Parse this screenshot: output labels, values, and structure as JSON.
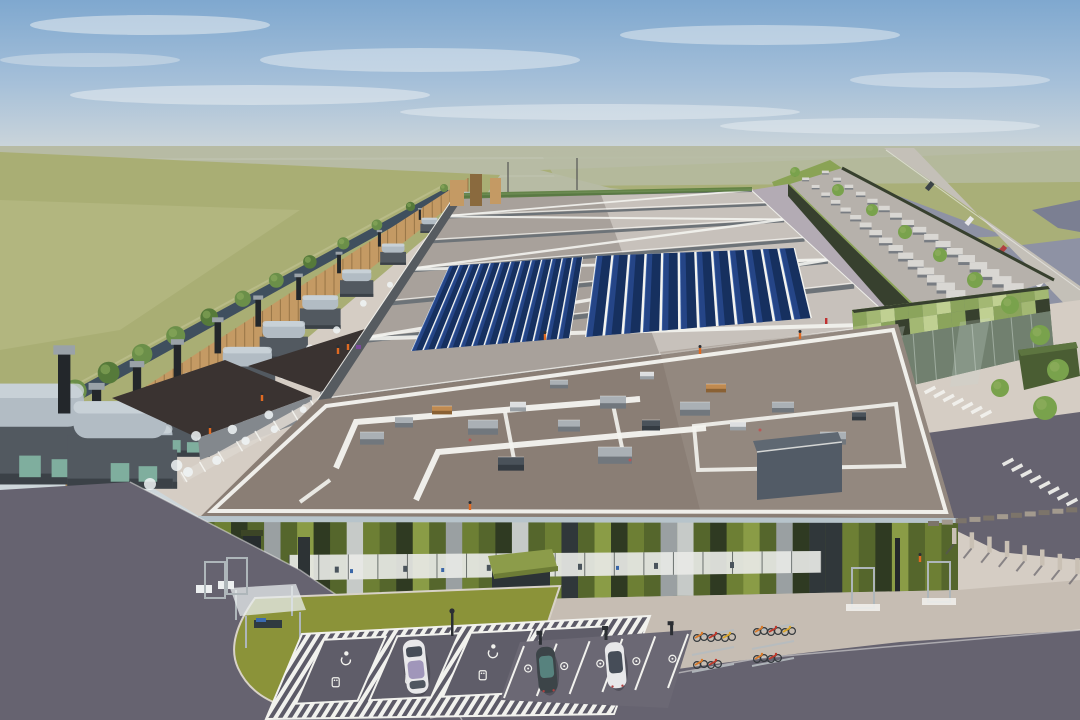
{
  "meta": {
    "title": "Aerial architectural rendering of a large data-center campus with solar roof, generator yard, green-panel office facade, EV parking and bike racks"
  },
  "palette": {
    "sky_top": "#7fa8cf",
    "sky_mid": "#a6c0d9",
    "sky_horizon": "#cdd6da",
    "cloud": "#e8edf1",
    "far_field": "#b7bba4",
    "field_left": "#a9ae74",
    "field_left_light": "#c2c595",
    "field_right": "#a9af78",
    "pond": "#8e92a4",
    "pond_dark": "#7b7f92",
    "canal": "#3f4f5e",
    "bush": "#6b8f49",
    "bush_dark": "#567a3a",
    "tree": "#79a24c",
    "tree_light": "#8fae5e",
    "berm": "#8aa355",
    "road_on_berm": "#c4c0b8",
    "timber": "#c49a64",
    "timber_dark": "#8a6a3e",
    "gen_body": "#525960",
    "gen_top": "#b2bcc4",
    "gen_top_light": "#cdd6dc",
    "gen_base": "#3b4147",
    "gen_teal": "#7fae9e",
    "stack": "#23272b",
    "stack_cap": "#9aa2a8",
    "steam": "#f0f4f6",
    "dark_roof": "#3a3331",
    "dark_roof2": "#46403d",
    "dark_wall": "#83888d",
    "main_roof_left": "#a8a19b",
    "main_roof_right": "#c7c1bb",
    "beam": "#6d7378",
    "roof_white": "#f4f4f0",
    "solar_dark": "#16305f",
    "solar_mid": "#27488c",
    "solar_light": "#3f68b0",
    "front_roof": "#8a7e75",
    "front_roof_light": "#9b9087",
    "equip_top": "#aab0b5",
    "equip_side": "#71777d",
    "white_top": "#dcdee0",
    "white_side": "#9aa0a5",
    "charcoal_top": "#4a525a",
    "charcoal_side": "#343b42",
    "tan_top": "#c08a50",
    "tan_side": "#8a6134",
    "screen_box": "#525b66",
    "screen_top": "#5f6872",
    "green_wall_dark": "#37402e",
    "right_roof": "#b6b1ab",
    "unit_white": "#d9d7d3",
    "court": "#b3abb4",
    "pavilion_green1": "#a3b873",
    "pavilion_green2": "#8ba45c",
    "pavilion_green3": "#c0d092",
    "glass": "#71806f",
    "glass_light": "#c3cfc6",
    "hedge_box": "#4a5d33",
    "hedge_box_top": "#5d7540",
    "f_dark": "#2f3a22",
    "f_olive": "#55662c",
    "f_mid": "#6d7f34",
    "f_bright": "#8a9c46",
    "f_gray": "#9aa0a2",
    "f_light": "#c6cac8",
    "f_charcoal": "#30373a",
    "parapet": "#b7c4cb",
    "window": "#e8e9e6",
    "window_frame": "#3a4140",
    "canopy": "#8c9c4a",
    "canopy_dark": "#6d7c36",
    "apron": "#c6bdb3",
    "apron_light": "#d5cdc4",
    "asphalt": "#666370",
    "asphalt2": "#6b6874",
    "lawn": "#8b9339",
    "hatch_dark": "#5c5a67",
    "stall": "#5f5d69",
    "line_white": "#f2f2ee",
    "car_white": "#e8e8ea",
    "car_dark": "#3c4448",
    "car_glass": "#343c48",
    "car_teal": "#5a8a84",
    "car_red": "#b04040",
    "car_roof_purple": "#7a6aa0",
    "post_dark": "#2b2e33",
    "rack_metal": "#aeb6ba",
    "fence_post": "#c9c0b4",
    "fence_shadow": "#55525c",
    "person": "#e06a22",
    "person_red": "#c03030",
    "person_purple": "#7a4a9a",
    "head": "#2c2f33"
  },
  "scene": {
    "roof": {
      "bay_fractions": [
        0,
        0.1,
        0.22,
        0.36,
        0.52,
        0.7,
        1
      ]
    },
    "solar": {
      "rows_a": 13,
      "rows_b": 12
    },
    "generators": {
      "count": 10
    },
    "fence": {
      "plank_count": 46
    },
    "canal_bushes": 14,
    "right_hall": {
      "units_per_row": 17,
      "rows": [
        0.3,
        0.68
      ]
    },
    "pavilion": {
      "checker_columns": 14,
      "checker_rows": 2
    },
    "facade": {
      "panel_pattern": [
        "o",
        "m",
        "d",
        "o",
        "g",
        "o",
        "b",
        "d",
        "o",
        "w",
        "m",
        "o",
        "d",
        "b",
        "o",
        "g",
        "m",
        "o",
        "d",
        "w",
        "o",
        "m",
        "c",
        "o",
        "b",
        "d",
        "m",
        "o",
        "g",
        "w",
        "o",
        "d",
        "m",
        "b",
        "o",
        "g",
        "d",
        "c",
        "c",
        "m",
        "o",
        "d",
        "b",
        "o",
        "m",
        "o"
      ],
      "panel_color_map": {
        "d": "f_dark",
        "o": "f_olive",
        "m": "f_mid",
        "b": "f_bright",
        "g": "f_gray",
        "w": "f_light",
        "c": "f_charcoal"
      },
      "window_mullions": 18
    },
    "parking": {
      "accessible_stalls": 4,
      "standard_stalls": 6,
      "charger_posts": 3
    },
    "bikes": {
      "clusters": 2,
      "per_cluster": 5,
      "colors": [
        "bike_orange",
        "bike_red",
        "bike_yellow",
        "bike_orange",
        "bike_red"
      ],
      "color_values": {
        "bike_orange": "#d97a2a",
        "bike_red": "#c0392b",
        "bike_yellow": "#d8a62a"
      }
    },
    "fence_posts": 8,
    "low_wall_blocks": 12,
    "chevrons": {
      "group_a": 7,
      "group_b": 8
    },
    "highway_cars": [
      "car_dark",
      "car_white",
      "car_red",
      "car_white"
    ],
    "berm_trees": 11,
    "people_count": 10
  }
}
